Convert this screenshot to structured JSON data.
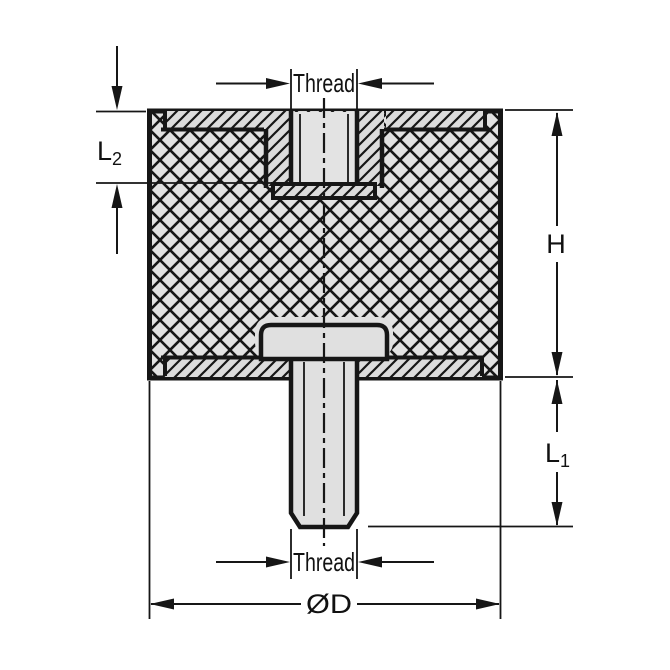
{
  "diagram": {
    "labels": {
      "thread_top": "Thread",
      "thread_bottom": "Thread",
      "height": "H",
      "l1_base": "L",
      "l1_sub": "1",
      "l2_base": "L",
      "l2_sub": "2",
      "diameter": "ØD"
    },
    "colors": {
      "line": "#1a1a1a",
      "rubber_fill": "#e2e2e2",
      "metal_fill": "#dcdcdc",
      "stud_fill": "#e0e0e0",
      "background": "#ffffff"
    }
  }
}
